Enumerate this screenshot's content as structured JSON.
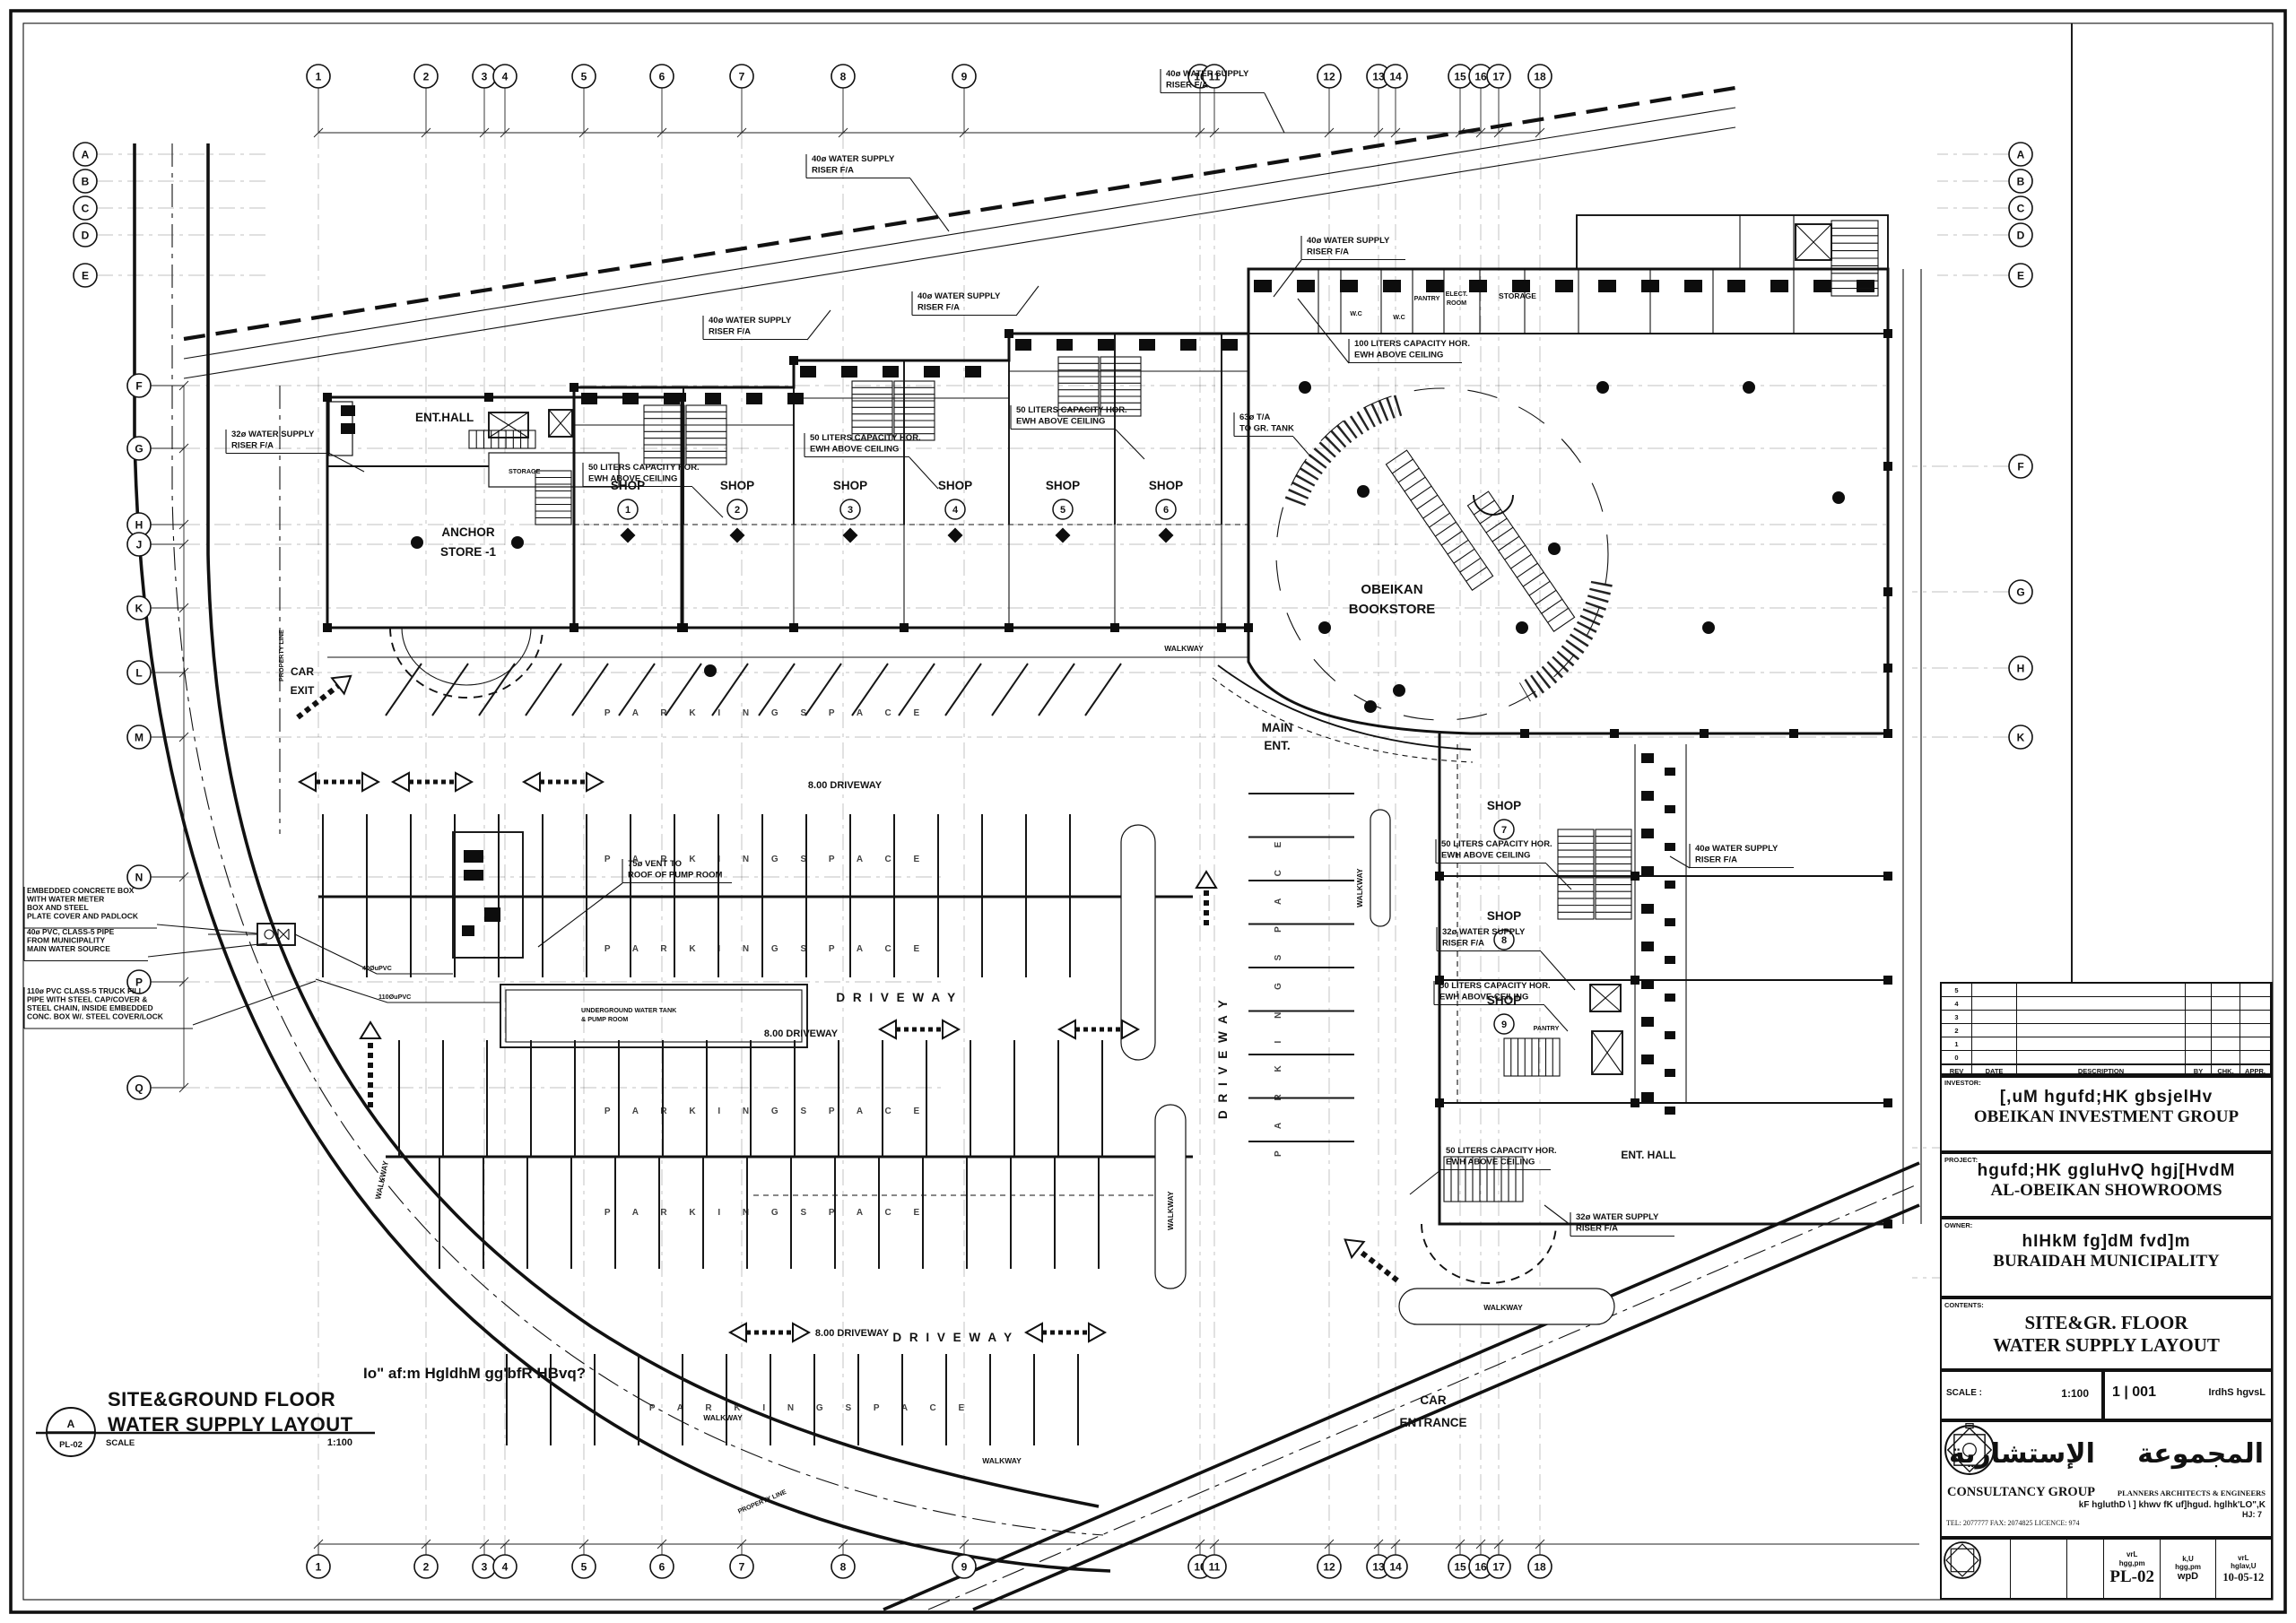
{
  "d": {
    "view_title": {
      "line1": "SITE&GROUND FLOOR",
      "line2": "WATER SUPPLY LAYOUT",
      "scale_label": "SCALE",
      "scale_value": "1:100",
      "ref_top": "A",
      "ref_bottom": "PL-02"
    },
    "arabic_note": "Io\"  af:m  HgldhM  gg'bfR  HBvq?",
    "rooms": {
      "ent_hall": "ENT.HALL",
      "storage": "STORAGE",
      "anchor1": "ANCHOR",
      "anchor2": "STORE -1",
      "shop": "SHOP",
      "book1": "OBEIKAN",
      "book2": "BOOKSTORE",
      "wc": "W.C",
      "pantry": "PANTRY",
      "elect1": "ELECT.",
      "elect2": "ROOM",
      "ent_hall2": "ENT. HALL"
    },
    "shop_numbers": [
      "1",
      "2",
      "3",
      "4",
      "5",
      "6",
      "7",
      "8",
      "9"
    ],
    "circ": {
      "walkway": "WALKWAY",
      "driveway": "D R I V E W A Y",
      "driveway8": "8.00 DRIVEWAY",
      "parking": "P A R K I N G      S P A C E",
      "main1": "MAIN",
      "main2": "ENT.",
      "car_exit1": "CAR",
      "car_exit2": "EXIT",
      "car_ent1": "CAR",
      "car_ent2": "ENTRANCE",
      "prop": "PROPERTY LINE"
    },
    "notes": {
      "ewh50a": "50 LITERS CAPACITY HOR.",
      "ewh50b": "EWH ABOVE CEILING",
      "ewh100a": "100 LITERS CAPACITY HOR.",
      "ewh100b": "EWH ABOVE CEILING",
      "r40a": "40ø WATER SUPPLY",
      "r40b": "RISER F/A",
      "r32a": "32ø WATER SUPPLY",
      "r32b": "RISER F/A",
      "vent1": "75ø VENT TO",
      "vent2": "ROOF OF PUMP ROOM",
      "ta1": "63ø T/A",
      "ta2": "TO GR. TANK",
      "meter": [
        "EMBEDDED CONCRETE BOX",
        "WITH WATER METER",
        "BOX AND STEEL",
        "PLATE COVER AND PADLOCK"
      ],
      "pvc": [
        "40ø PVC, CLASS-5 PIPE",
        "FROM MUNICIPALITY",
        "MAIN WATER SOURCE"
      ],
      "truck": [
        "110ø PVC CLASS-5 TRUCK FILL",
        "PIPE WITH STEEL CAP/COVER &",
        "STEEL CHAIN, INSIDE EMBEDDED",
        "CONC. BOX W/. STEEL COVER/LOCK"
      ],
      "upvc40": "40ØuPVC",
      "upvc110": "110ØuPVC",
      "tank1": "UNDERGROUND WATER TANK",
      "tank2": "& PUMP ROOM"
    },
    "grid": {
      "top": [
        "1",
        "2",
        "3",
        "4",
        "5",
        "6",
        "7",
        "8",
        "9",
        "10",
        "11",
        "12",
        "13",
        "14",
        "15",
        "16",
        "17",
        "18"
      ],
      "bottom": [
        "1",
        "2",
        "3",
        "4",
        "5",
        "6",
        "7",
        "8",
        "9",
        "10",
        "11",
        "12",
        "13",
        "14",
        "15",
        "16",
        "17",
        "18"
      ],
      "left_outer": [
        "A",
        "B",
        "C",
        "D",
        "E"
      ],
      "left_inner": [
        "F",
        "G",
        "H",
        "J",
        "K",
        "L",
        "M",
        "N",
        "P",
        "Q"
      ],
      "right": [
        "F",
        "G",
        "H",
        "K",
        "N",
        "P"
      ]
    }
  },
  "tb": {
    "rev_headers": [
      "REV",
      "DATE",
      "DESCRIPTION",
      "BY",
      "CHK.",
      "APPR."
    ],
    "rev_numbers": [
      "5",
      "4",
      "3",
      "2",
      "1",
      "0"
    ],
    "investor": {
      "label": "INVESTOR:",
      "arabic": "[,uM  hgufd;HK  gbsjelHv",
      "english": "OBEIKAN INVESTMENT GROUP"
    },
    "project": {
      "label": "PROJECT:",
      "arabic": "hgufd;HK  ggluHvQ  hgj[HvdM",
      "english": "AL-OBEIKAN SHOWROOMS"
    },
    "owner": {
      "label": "OWNER:",
      "arabic": "hIHkM  fg]dM  fvd]m",
      "english": "BURAIDAH  MUNICIPALITY"
    },
    "contents": {
      "label": "CONTENTS:",
      "line1": "SITE&GR. FLOOR",
      "line2": "WATER SUPPLY LAYOUT"
    },
    "scale": {
      "label": "SCALE :",
      "value": "1:100",
      "sheet": "1 | 001",
      "sheet_ar": "IrdhS  hgvsL"
    },
    "firm": {
      "ar_left": "الإستشارية",
      "ar_right": "المجموعة",
      "name": "CONSULTANCY GROUP",
      "subtitle": "PLANNERS ARCHITECTS & ENGINEERS",
      "ar_line": "kF  hgluthD \\ ]  khwv  fK  uf]hgud.  hglhk'LO\",K",
      "ar_line2": "HJ: 7",
      "contact": "TEL: 2077777   FAX: 2074825   LICENCE: 974"
    },
    "strip": {
      "c4l1": "vrL",
      "c4l2": "hgg,pm",
      "c4v": "PL-02",
      "c5l1": "k,U",
      "c5l2": "hgg,pm",
      "c5v": "wpD",
      "c6l1": "vrL",
      "c6l2": "hglav,U",
      "c6v": "10-05-12"
    }
  }
}
